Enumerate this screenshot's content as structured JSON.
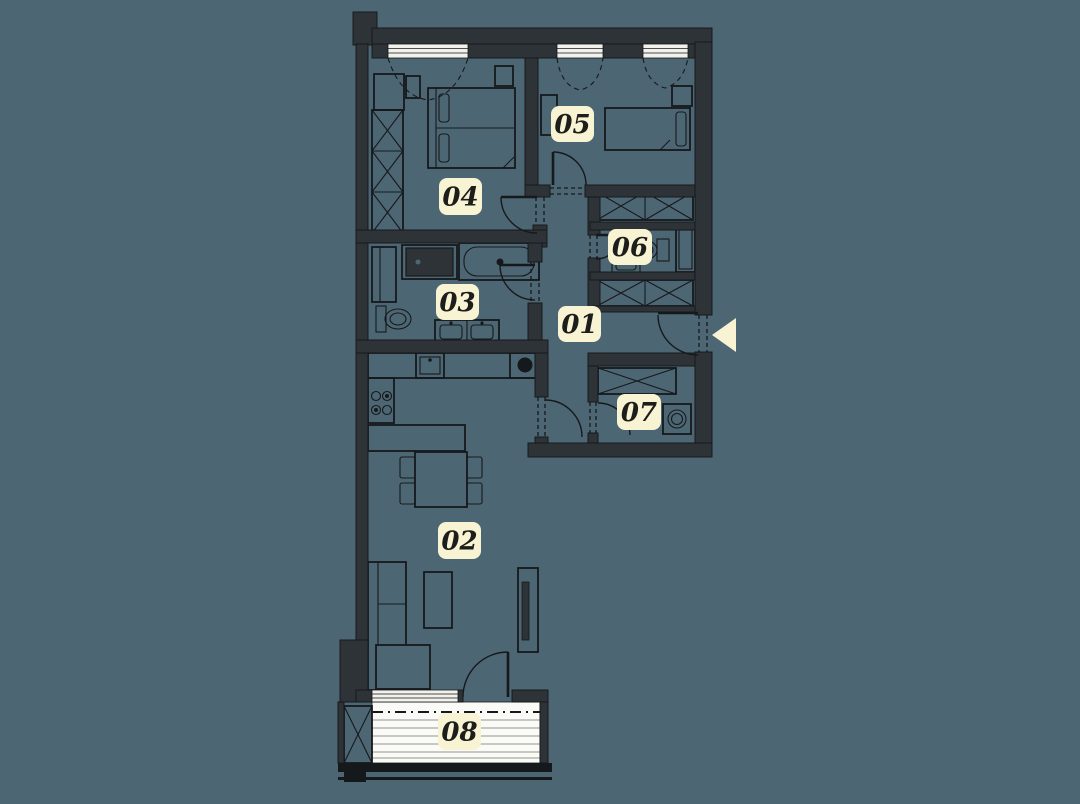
{
  "plan": {
    "title": "apartment-floor-plan",
    "colors": {
      "background": "#4d6673",
      "wall": "#2e3337",
      "line": "#16191c",
      "label_bg": "#f8f3d2",
      "label_text": "#1d1d1b",
      "window": "#f2f1ec",
      "deck": "#fafaf7",
      "deck_line": "#c8c8c2",
      "arrow": "#f8f3d2"
    },
    "rooms": [
      {
        "number": "01"
      },
      {
        "number": "02"
      },
      {
        "number": "03"
      },
      {
        "number": "04"
      },
      {
        "number": "05"
      },
      {
        "number": "06"
      },
      {
        "number": "07"
      },
      {
        "number": "08"
      }
    ],
    "entrance": {
      "symbol": "entrance-arrow",
      "direction": "left"
    }
  }
}
